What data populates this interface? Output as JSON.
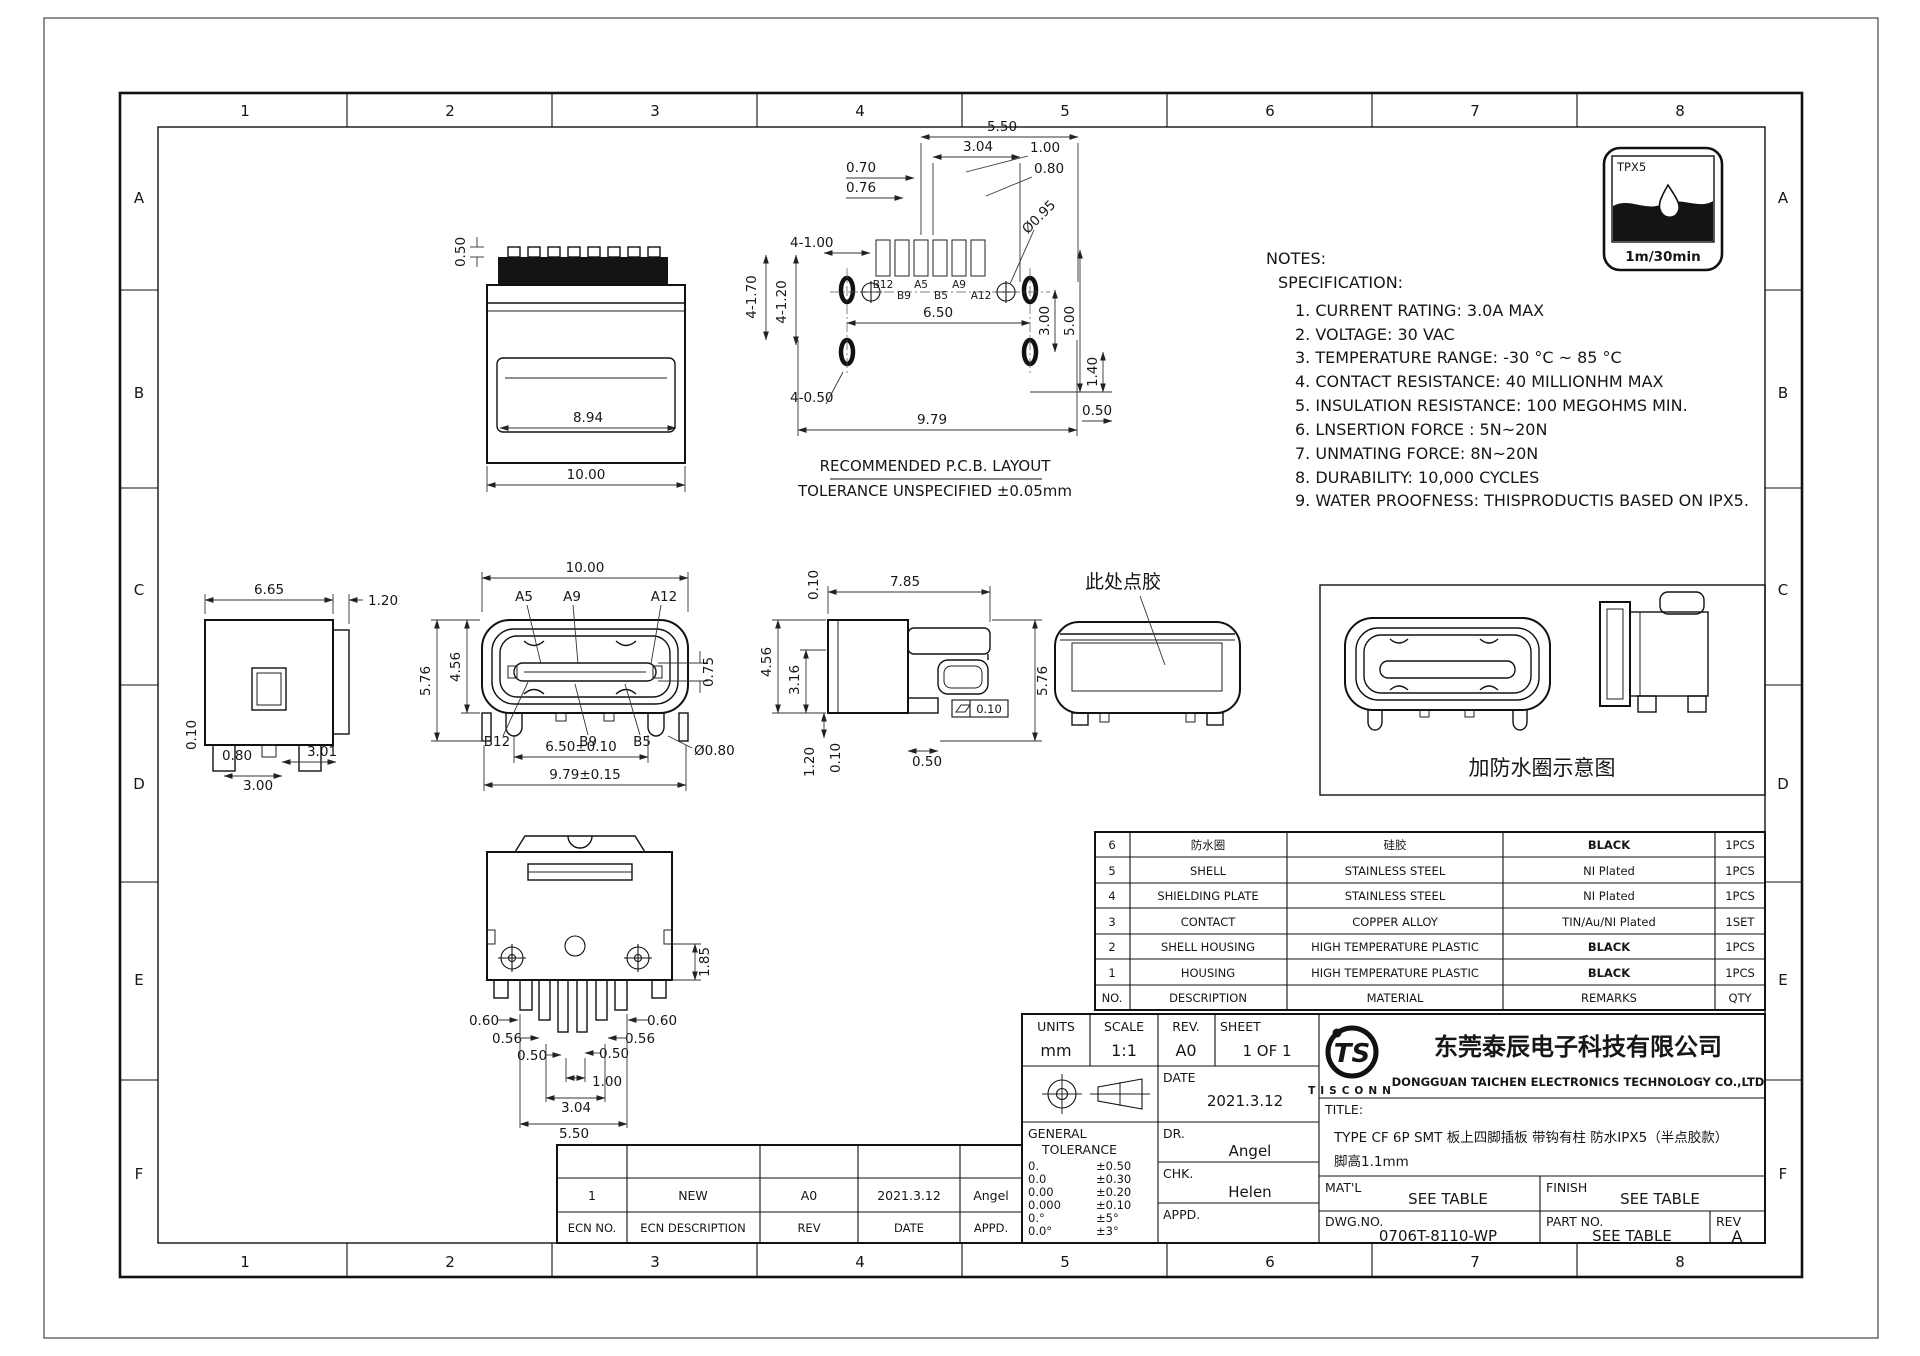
{
  "sheet": {
    "cols": [
      "1",
      "2",
      "3",
      "4",
      "5",
      "6",
      "7",
      "8"
    ],
    "rows": [
      "A",
      "B",
      "C",
      "D",
      "E",
      "F"
    ]
  },
  "badge": {
    "label": "TPX5",
    "caption": "1m/30min"
  },
  "notes": {
    "heading": "NOTES:",
    "sub": "SPECIFICATION:",
    "items": [
      "1. CURRENT RATING: 3.0A MAX",
      "2. VOLTAGE: 30 VAC",
      "3. TEMPERATURE RANGE: -30 °C ~ 85 °C",
      "4. CONTACT RESISTANCE: 40 MILLIONHM MAX",
      "5. INSULATION RESISTANCE: 100 MEGOHMS MIN.",
      "6. LNSERTION FORCE : 5N~20N",
      "7. UNMATING FORCE: 8N~20N",
      "8. DURABILITY:   10,000 CYCLES",
      "9. WATER PROOFNESS: THISPRODUCTIS BASED ON IPX5."
    ]
  },
  "views": {
    "top": {
      "d050": "0.50",
      "d894": "8.94",
      "d1000": "10.00"
    },
    "pcb": {
      "cap1": "RECOMMENDED  P.C.B. LAYOUT",
      "cap2": "TOLERANCE UNSPECIFIED ±0.05mm",
      "d550": "5.50",
      "d304": "3.04",
      "d100": "1.00",
      "d080": "0.80",
      "d070": "0.70",
      "d076": "0.76",
      "d4100": "4-1.00",
      "d4170": "4-1.70",
      "d4120": "4-1.20",
      "d095": "Ø0.95",
      "d650": "6.50",
      "d300": "3.00",
      "d500": "5.00",
      "d140": "1.40",
      "d4050": "4-0.50",
      "d979": "9.79",
      "d050": "0.50",
      "pins": [
        "B12",
        "B9",
        "A5",
        "B5",
        "A9",
        "A12"
      ]
    },
    "left": {
      "d665": "6.65",
      "d120": "1.20",
      "d010": "0.10",
      "d080": "0.80",
      "d300": "3.00",
      "d301": "3.01"
    },
    "front": {
      "d1000": "10.00",
      "d576": "5.76",
      "d456": "4.56",
      "d075": "0.75",
      "d650": "6.50±0.10",
      "d979": "9.79±0.15",
      "d080": "Ø0.80",
      "a5": "A5",
      "a9": "A9",
      "a12": "A12",
      "b12": "B12",
      "b9": "B9",
      "b5": "B5"
    },
    "side": {
      "d010t": "0.10",
      "d785": "7.85",
      "d456": "4.56",
      "d316": "3.16",
      "d120": "1.20",
      "d010b": "0.10",
      "d050": "0.50",
      "d576": "5.76",
      "flat": "0.10"
    },
    "glue": {
      "note": "此处点胶"
    },
    "ring": {
      "caption": "加防水圈示意图"
    },
    "bottom": {
      "d185": "1.85",
      "d060": "0.60",
      "d056": "0.56",
      "d050": "0.50",
      "d100": "1.00",
      "d304": "3.04",
      "d550": "5.50"
    }
  },
  "bom": {
    "headers": [
      "NO.",
      "DESCRIPTION",
      "MATERIAL",
      "REMARKS",
      "QTY"
    ],
    "rows": [
      [
        "6",
        "防水圈",
        "硅胶",
        "BLACK",
        "1PCS"
      ],
      [
        "5",
        "SHELL",
        "STAINLESS STEEL",
        "NI Plated",
        "1PCS"
      ],
      [
        "4",
        "SHIELDING PLATE",
        "STAINLESS STEEL",
        "NI Plated",
        "1PCS"
      ],
      [
        "3",
        "CONTACT",
        "COPPER ALLOY",
        "TIN/Au/NI Plated",
        "1SET"
      ],
      [
        "2",
        "SHELL HOUSING",
        "HIGH TEMPERATURE PLASTIC",
        "BLACK",
        "1PCS"
      ],
      [
        "1",
        "HOUSING",
        "HIGH TEMPERATURE PLASTIC",
        "BLACK",
        "1PCS"
      ]
    ]
  },
  "tb": {
    "units_label": "UNITS",
    "units": "mm",
    "scale_label": "SCALE",
    "scale": "1:1",
    "rev_label": "REV.",
    "rev": "A0",
    "sheet_label": "SHEET",
    "sheet": "1 OF 1",
    "date_label": "DATE",
    "date": "2021.3.12",
    "dr_label": "DR.",
    "dr": "Angel",
    "chk_label": "CHK.",
    "chk": "Helen",
    "appd_label": "APPD.",
    "appd": "",
    "gt1": "GENERAL",
    "gt2": "TOLERANCE",
    "tol": [
      [
        "0.",
        "±0.50"
      ],
      [
        "0.0",
        "±0.30"
      ],
      [
        "0.00",
        "±0.20"
      ],
      [
        "0.000",
        "±0.10"
      ],
      [
        "0.°",
        "±5°"
      ],
      [
        "0.0°",
        "±3°"
      ]
    ],
    "logo_monogram": "TS",
    "logo_text": "TISCONN",
    "company_cn": "东莞泰辰电子科技有限公司",
    "company_en": "DONGGUAN TAICHEN ELECTRONICS TECHNOLOGY CO.,LTD",
    "title_label": "TITLE:",
    "title_line1": "TYPE CF 6P SMT 板上四脚插板 带钩有柱 防水IPX5（半点胶款）",
    "title_line2": "脚高1.1mm",
    "matl_label": "MAT'L",
    "matl": "SEE TABLE",
    "finish_label": "FINISH",
    "finish": "SEE TABLE",
    "dwg_label": "DWG.NO.",
    "dwg": "0706T-8110-WP",
    "part_label": "PART NO.",
    "part": "SEE TABLE",
    "rev2_label": "REV",
    "rev2": "A"
  },
  "rev": {
    "row": [
      "1",
      "NEW",
      "A0",
      "2021.3.12",
      "Angel"
    ],
    "headers": [
      "ECN NO.",
      "ECN  DESCRIPTION",
      "REV",
      "DATE",
      "APPD."
    ]
  }
}
